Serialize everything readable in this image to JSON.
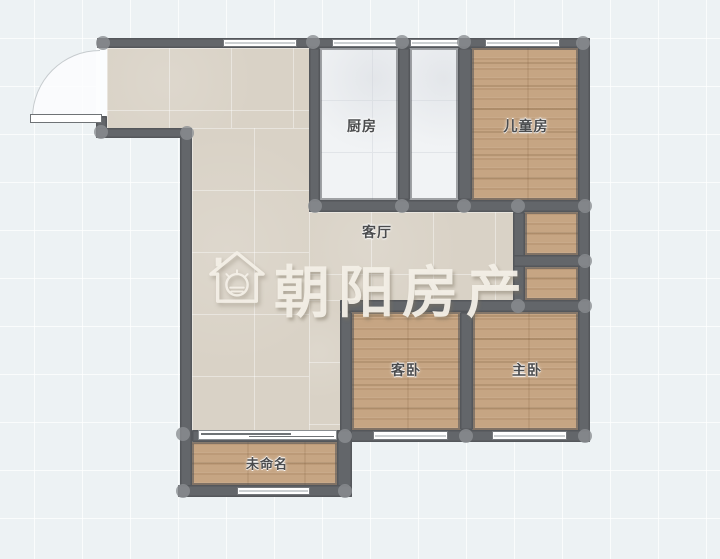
{
  "plan_type": "residential-floor-plan",
  "watermark": {
    "brand": "朝阳房产",
    "icon": "house-sun-logo"
  },
  "rooms": {
    "kitchen": {
      "label": "厨房"
    },
    "children_room": {
      "label": "儿童房"
    },
    "living_room": {
      "label": "客厅"
    },
    "guest_bedroom": {
      "label": "客卧"
    },
    "master_bedroom": {
      "label": "主卧"
    },
    "unnamed_balcony": {
      "label": "未命名"
    }
  },
  "colors": {
    "wall": "#63666a",
    "background": "#edf2f4",
    "floor_beige": "#d9d2c6",
    "floor_marble": "#f1f3f5",
    "floor_wood": "#c6a583",
    "window_fill": "#ffffff",
    "node_handle": "#8b8e92",
    "label_text": "#4b4c4e",
    "watermark_text": "#f3efe7"
  }
}
